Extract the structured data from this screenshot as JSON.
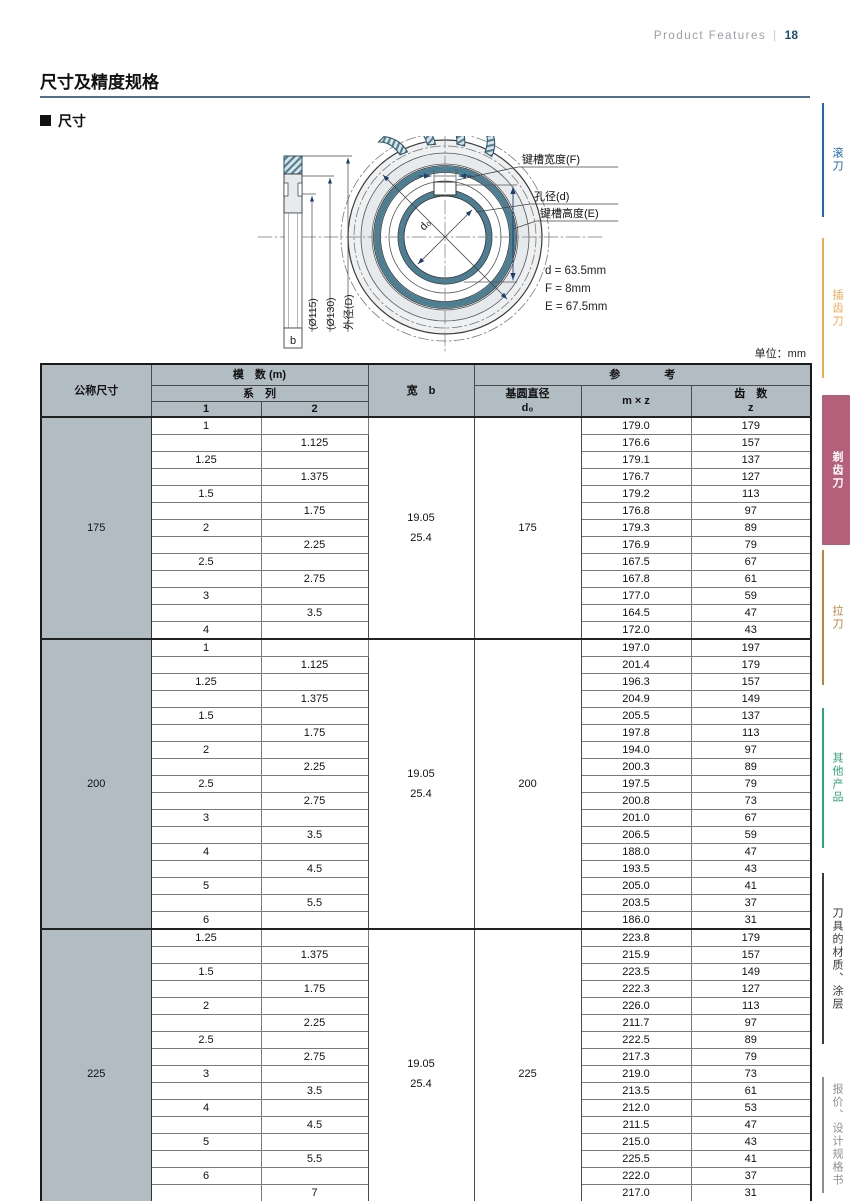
{
  "page": {
    "header_right": {
      "label": "Product Features",
      "divider": "|",
      "page_num": "18"
    },
    "title": "尺寸及精度规格",
    "section_heading": "尺寸",
    "unit_label": "单位：mm"
  },
  "diagram": {
    "labels": {
      "keyway_width": "键槽宽度(F)",
      "bore_dia": "孔径(d)",
      "keyway_height": "键槽高度(E)",
      "dim_115": "(Ø115)",
      "dim_130": "(Ø130)",
      "outer_dia": "外径(D)",
      "width_b": "b",
      "base_circle": "d₀"
    },
    "values": {
      "d": "d = 63.5mm",
      "F": "F = 8mm",
      "E": "E = 67.5mm"
    }
  },
  "sidebar": {
    "tabs": [
      {
        "label": "滚刀",
        "color": "#1c6ab2",
        "active": false
      },
      {
        "label": "插齿刀",
        "color": "#f0a851",
        "active": false
      },
      {
        "label": "剃齿刀",
        "color": "#b5607a",
        "active": true
      },
      {
        "label": "拉刀",
        "color": "#bd8440",
        "active": false
      },
      {
        "label": "其他产品",
        "color": "#2fa379",
        "active": false
      },
      {
        "label": "刀具的材质、涂层",
        "color": "#3a3a3a",
        "active": false
      },
      {
        "label": "报价、设计规格书",
        "color": "#8f8f8f",
        "active": false
      }
    ]
  },
  "table": {
    "headers": {
      "nominal": "公称尺寸",
      "module_group": "模　数  (m)",
      "series": "系　列",
      "col1": "1",
      "col2": "2",
      "width": "宽　b",
      "reference": "参　　　　考",
      "base_dia_line1": "基圆直径",
      "base_dia_line2": "d₀",
      "mxz": "m × z",
      "teeth_line1": "齿　数",
      "teeth_line2": "z"
    },
    "sections": [
      {
        "nominal": "175",
        "width_b": [
          "19.05",
          "25.4"
        ],
        "d0": "175",
        "rows": [
          [
            "1",
            "",
            "179.0",
            "179"
          ],
          [
            "",
            "1.125",
            "176.6",
            "157"
          ],
          [
            "1.25",
            "",
            "179.1",
            "137"
          ],
          [
            "",
            "1.375",
            "176.7",
            "127"
          ],
          [
            "1.5",
            "",
            "179.2",
            "113"
          ],
          [
            "",
            "1.75",
            "176.8",
            "97"
          ],
          [
            "2",
            "",
            "179.3",
            "89"
          ],
          [
            "",
            "2.25",
            "176.9",
            "79"
          ],
          [
            "2.5",
            "",
            "167.5",
            "67"
          ],
          [
            "",
            "2.75",
            "167.8",
            "61"
          ],
          [
            "3",
            "",
            "177.0",
            "59"
          ],
          [
            "",
            "3.5",
            "164.5",
            "47"
          ],
          [
            "4",
            "",
            "172.0",
            "43"
          ]
        ]
      },
      {
        "nominal": "200",
        "width_b": [
          "19.05",
          "25.4"
        ],
        "d0": "200",
        "rows": [
          [
            "1",
            "",
            "197.0",
            "197"
          ],
          [
            "",
            "1.125",
            "201.4",
            "179"
          ],
          [
            "1.25",
            "",
            "196.3",
            "157"
          ],
          [
            "",
            "1.375",
            "204.9",
            "149"
          ],
          [
            "1.5",
            "",
            "205.5",
            "137"
          ],
          [
            "",
            "1.75",
            "197.8",
            "113"
          ],
          [
            "2",
            "",
            "194.0",
            "97"
          ],
          [
            "",
            "2.25",
            "200.3",
            "89"
          ],
          [
            "2.5",
            "",
            "197.5",
            "79"
          ],
          [
            "",
            "2.75",
            "200.8",
            "73"
          ],
          [
            "3",
            "",
            "201.0",
            "67"
          ],
          [
            "",
            "3.5",
            "206.5",
            "59"
          ],
          [
            "4",
            "",
            "188.0",
            "47"
          ],
          [
            "",
            "4.5",
            "193.5",
            "43"
          ],
          [
            "5",
            "",
            "205.0",
            "41"
          ],
          [
            "",
            "5.5",
            "203.5",
            "37"
          ],
          [
            "6",
            "",
            "186.0",
            "31"
          ]
        ]
      },
      {
        "nominal": "225",
        "width_b": [
          "19.05",
          "25.4"
        ],
        "d0": "225",
        "rows": [
          [
            "1.25",
            "",
            "223.8",
            "179"
          ],
          [
            "",
            "1.375",
            "215.9",
            "157"
          ],
          [
            "1.5",
            "",
            "223.5",
            "149"
          ],
          [
            "",
            "1.75",
            "222.3",
            "127"
          ],
          [
            "2",
            "",
            "226.0",
            "113"
          ],
          [
            "",
            "2.25",
            "211.7",
            "97"
          ],
          [
            "2.5",
            "",
            "222.5",
            "89"
          ],
          [
            "",
            "2.75",
            "217.3",
            "79"
          ],
          [
            "3",
            "",
            "219.0",
            "73"
          ],
          [
            "",
            "3.5",
            "213.5",
            "61"
          ],
          [
            "4",
            "",
            "212.0",
            "53"
          ],
          [
            "",
            "4.5",
            "211.5",
            "47"
          ],
          [
            "5",
            "",
            "215.0",
            "43"
          ],
          [
            "",
            "5.5",
            "225.5",
            "41"
          ],
          [
            "6",
            "",
            "222.0",
            "37"
          ],
          [
            "",
            "7",
            "217.0",
            "31"
          ],
          [
            "8",
            "",
            "232.0",
            "29"
          ]
        ]
      }
    ]
  }
}
